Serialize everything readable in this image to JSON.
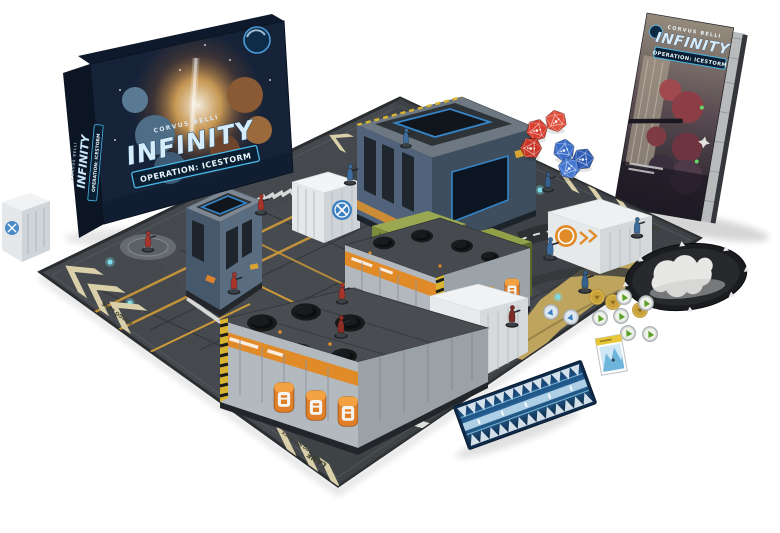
{
  "scene": {
    "background_color": "#ffffff"
  },
  "box": {
    "publisher": "CORVUS BELLI",
    "title": "INFINITY",
    "subtitle": "OPERATION: ICESTORM"
  },
  "book": {
    "publisher": "CORVUS BELLI",
    "title": "INFINITY",
    "subtitle": "OPERATION: ICESTORM"
  },
  "mat": {
    "label_cargo_lane": "CARGO LANE",
    "label_lane": "LANE",
    "label_do_not_block": "DO NOT BLOCK",
    "label_cargo": "CARGO"
  },
  "components": {
    "red_d20_dice": 3,
    "blue_d20_dice": 3,
    "red_miniatures": 6,
    "blue_miniatures": 6,
    "green_camo_tokens": 6,
    "gold_tokens": 3,
    "blue_tokens": 2,
    "smoke_template": 1,
    "ice_ruler": 1,
    "ice_card": 1,
    "terrain_buildings": 4,
    "white_cargo_containers": 4,
    "green_cargo_containers": 2
  },
  "colors": {
    "box_navy": "#152238",
    "logo_blue": "#d6ecfa",
    "banner_border": "#49b8e8",
    "mat_gray": "#45494d",
    "mat_tan": "#d9d0a9",
    "mat_gold": "#bfa45e",
    "building_blue": "#56697d",
    "building_gray": "#b2b9bf",
    "barrel_orange": "#e07f28",
    "container_green": "#7d8c3c",
    "container_white": "#eef0f1",
    "container_logo_blue": "#3a7fc1",
    "die_red": "#d94030",
    "die_blue": "#3a6cc8",
    "token_green": "#5da028",
    "token_gold": "#c9a23c",
    "mini_red": "#a8352c",
    "mini_blue": "#3e6d9d",
    "ruler_blue": "#123a66"
  }
}
